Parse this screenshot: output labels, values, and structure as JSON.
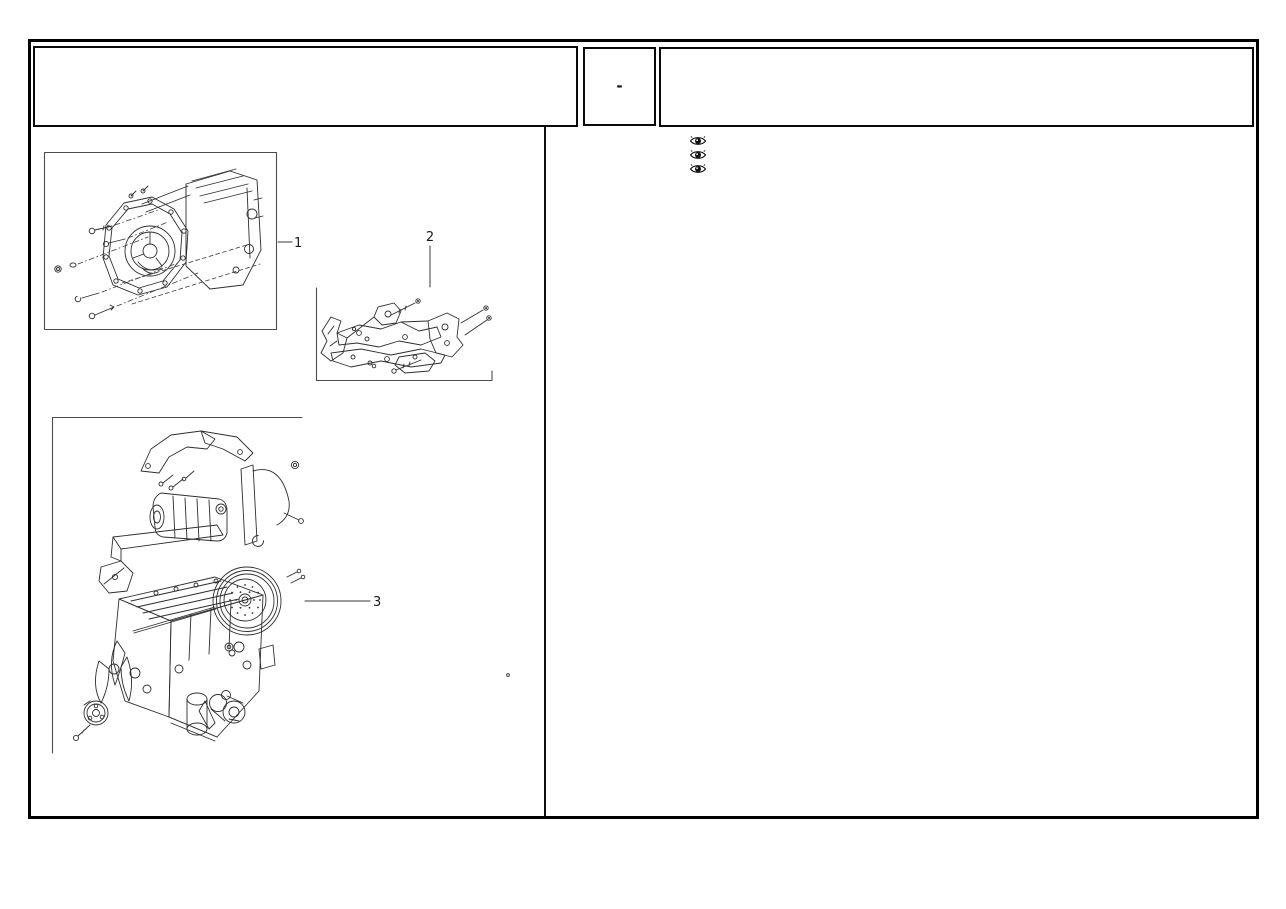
{
  "header": {
    "left_box_text": "",
    "code_box_text": "-",
    "right_box_text": ""
  },
  "legend_icons": [
    {
      "name": "eye-icon"
    },
    {
      "name": "eye-icon"
    },
    {
      "name": "eye-icon"
    }
  ],
  "figures": [
    {
      "callout": "1"
    },
    {
      "callout": "2"
    },
    {
      "callout": "3"
    }
  ],
  "colors": {
    "page_border": "#000000",
    "line_art": "#2e2e2e",
    "frame_line": "#4d4d4d",
    "background": "#ffffff"
  }
}
